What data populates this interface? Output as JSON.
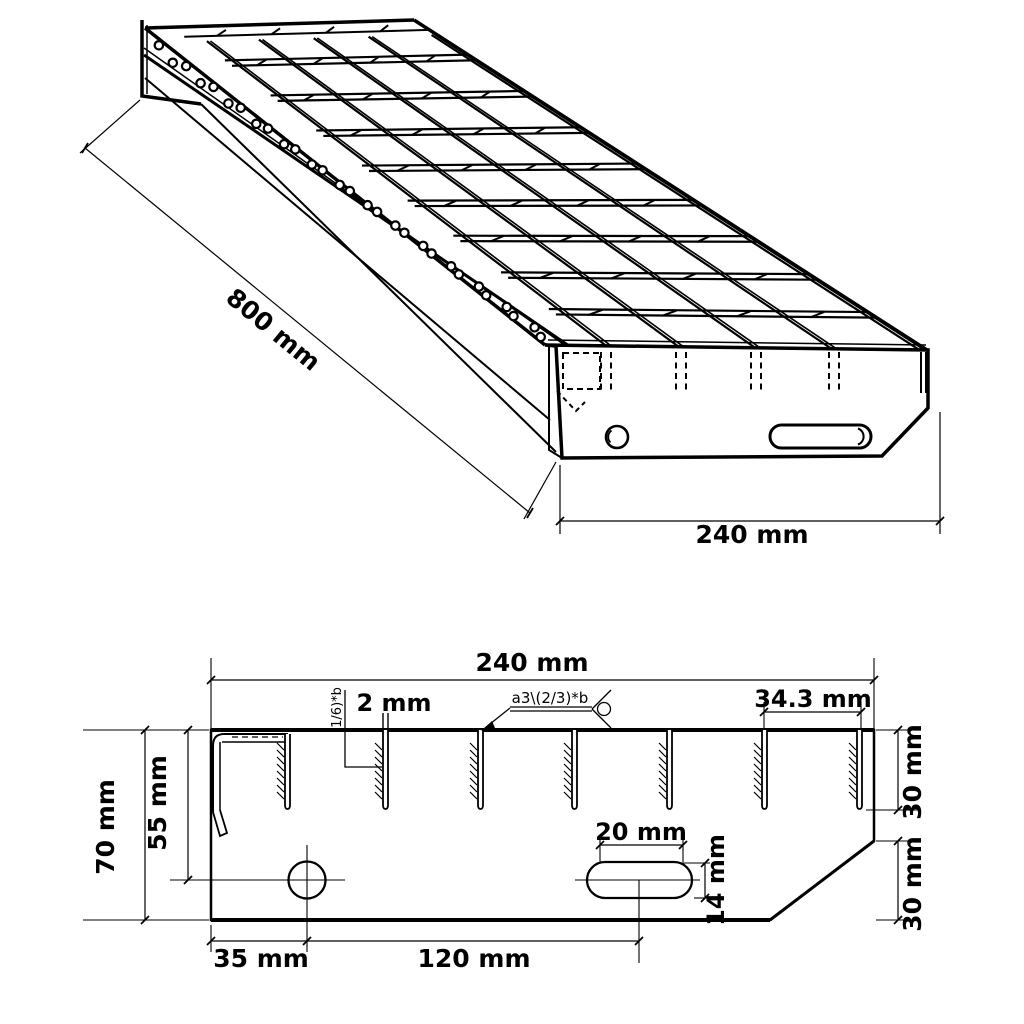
{
  "colors": {
    "line": "#000000",
    "background": "#ffffff"
  },
  "iso_view": {
    "length_label": "800 mm",
    "width_label": "240 mm"
  },
  "section_view": {
    "width_label": "240 mm",
    "bar_thickness_label": "2 mm",
    "weld_top_label": "a3\\(2/3)*b",
    "weld_side_label": "(1/6)*b",
    "bar_spacing_label": "34.3 mm",
    "bar_height_label": "30 mm",
    "chamfer_height_label": "30 mm",
    "slot_width_label": "20 mm",
    "slot_height_label": "14 mm",
    "plate_height_label": "70 mm",
    "hole_center_height_label": "55 mm",
    "hole_offset_label": "35 mm",
    "hole_slot_distance_label": "120 mm"
  }
}
